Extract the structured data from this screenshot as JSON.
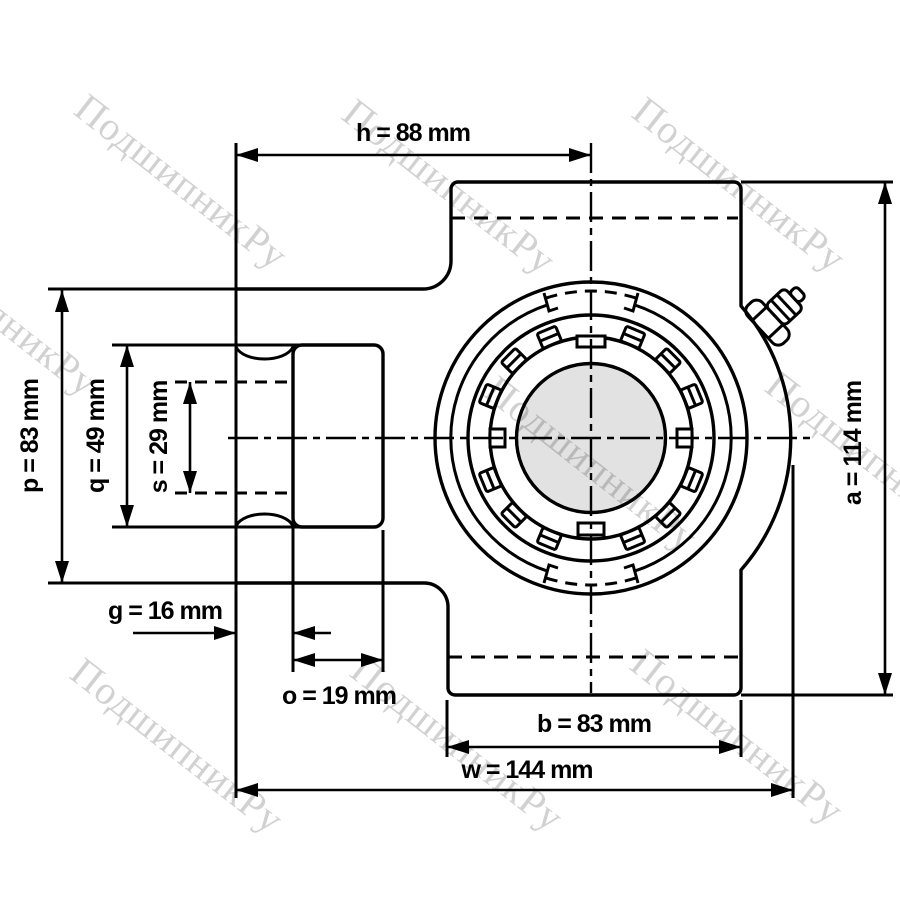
{
  "watermark": {
    "text": "ПодшипникРу"
  },
  "dimensions": {
    "h": {
      "label": "h = 88 mm"
    },
    "a": {
      "label": "a = 114 mm"
    },
    "p": {
      "label": "p = 83 mm"
    },
    "q": {
      "label": "q = 49 mm"
    },
    "s": {
      "label": "s = 29 mm"
    },
    "g": {
      "label": "g = 16 mm"
    },
    "o": {
      "label": "o = 19 mm"
    },
    "b": {
      "label": "b = 83 mm"
    },
    "w": {
      "label": "w = 144 mm"
    }
  },
  "colors": {
    "line": "#000000",
    "shaft_fill": "#e2e2e2",
    "background": "#ffffff"
  }
}
